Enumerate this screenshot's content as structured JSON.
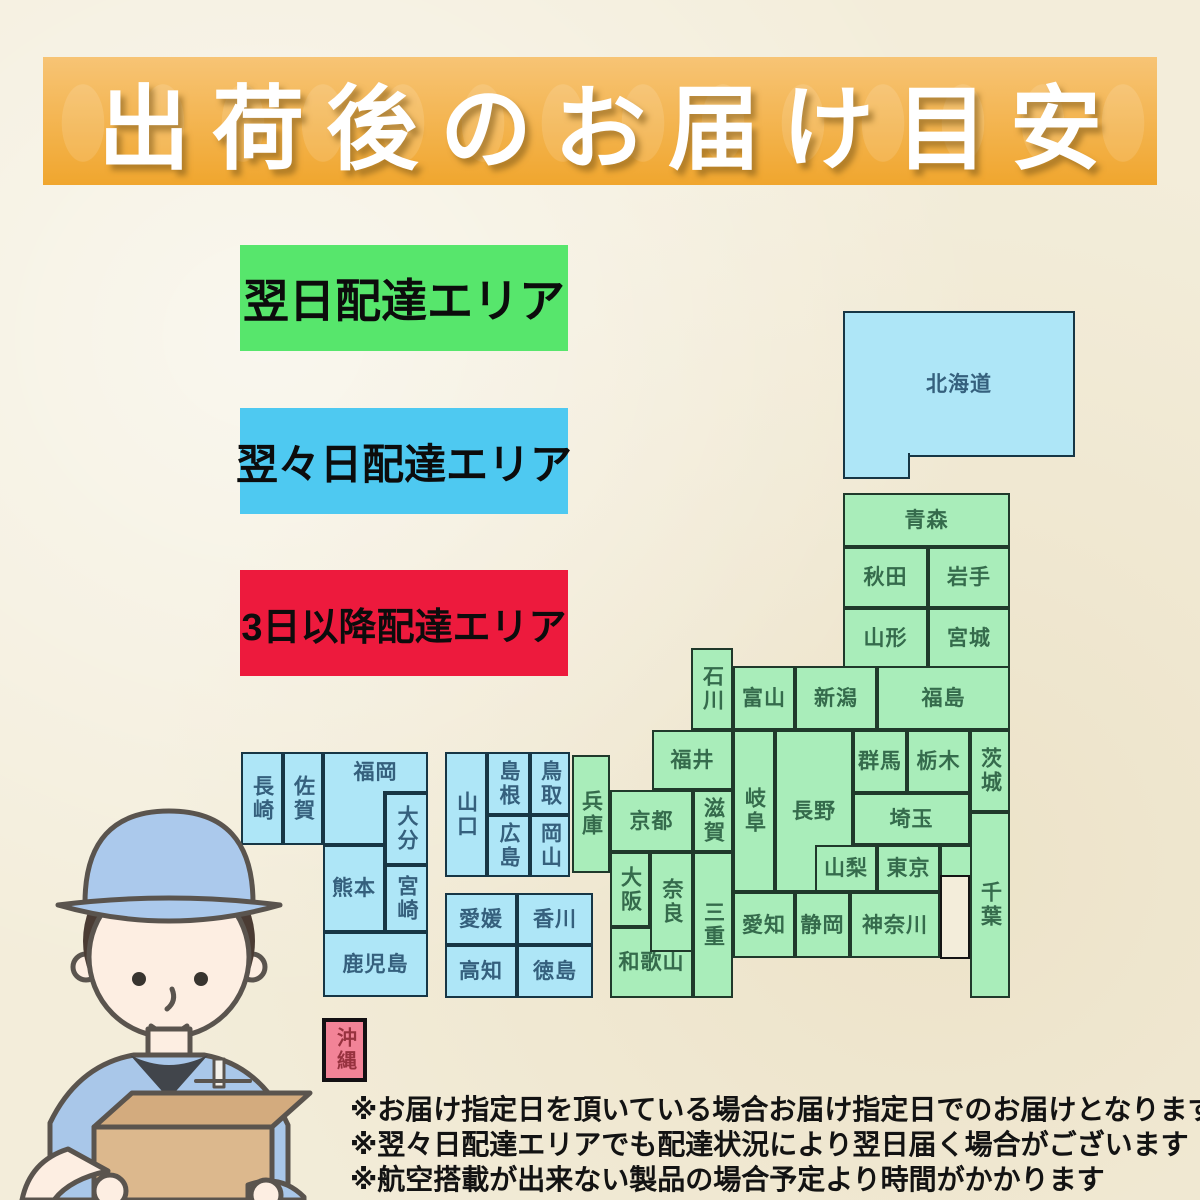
{
  "title": "出荷後のお届け目安",
  "legend": {
    "next_day": "翌日配達エリア",
    "two_day": "翌々日配達エリア",
    "three_day_plus": "3日以降配達エリア"
  },
  "colors": {
    "paper": "#f3edda",
    "banner_top": "#f7c475",
    "banner_bottom": "#f0a62e",
    "title_text": "#ffffff",
    "legend_green": "#57e66c",
    "legend_blue": "#4ec9f1",
    "legend_red": "#ed1a3d",
    "map_green": "#a9edba",
    "map_blue": "#aee6f7",
    "okinawa_pink": "#f28397"
  },
  "prefectures": {
    "hokkaido": "北海道",
    "aomori": "青森",
    "akita": "秋田",
    "iwate": "岩手",
    "yamagata": "山形",
    "miyagi": "宮城",
    "fukushima": "福島",
    "niigata": "新潟",
    "toyama": "富山",
    "ishikawa": "石川",
    "fukui": "福井",
    "gifu": "岐阜",
    "nagano": "長野",
    "gunma": "群馬",
    "tochigi": "栃木",
    "ibaraki": "茨城",
    "saitama": "埼玉",
    "chiba": "千葉",
    "yamanashi": "山梨",
    "tokyo": "東京",
    "aichi": "愛知",
    "shizuoka": "静岡",
    "kanagawa": "神奈川",
    "hyogo": "兵庫",
    "kyoto": "京都",
    "shiga": "滋賀",
    "osaka": "大阪",
    "nara": "奈良",
    "mie": "三重",
    "wakayama": "和歌山",
    "yamaguchi": "山口",
    "shimane": "島根",
    "tottori": "鳥取",
    "hiroshima": "広島",
    "okayama": "岡山",
    "ehime": "愛媛",
    "kagawa": "香川",
    "kochi": "高知",
    "tokushima": "徳島",
    "nagasaki": "長崎",
    "saga": "佐賀",
    "fukuoka": "福岡",
    "oita": "大分",
    "kumamoto": "熊本",
    "miyazaki": "宮崎",
    "kagoshima": "鹿児島",
    "okinawa": "沖縄"
  },
  "zone_assignment": {
    "next_day": [
      "青森",
      "秋田",
      "岩手",
      "山形",
      "宮城",
      "福島",
      "新潟",
      "富山",
      "石川",
      "福井",
      "岐阜",
      "長野",
      "群馬",
      "栃木",
      "茨城",
      "埼玉",
      "千葉",
      "山梨",
      "東京",
      "愛知",
      "静岡",
      "神奈川",
      "兵庫",
      "京都",
      "滋賀",
      "大阪",
      "奈良",
      "三重",
      "和歌山"
    ],
    "two_day": [
      "北海道",
      "山口",
      "島根",
      "鳥取",
      "広島",
      "岡山",
      "愛媛",
      "香川",
      "高知",
      "徳島",
      "長崎",
      "佐賀",
      "福岡",
      "大分",
      "熊本",
      "宮崎",
      "鹿児島"
    ],
    "three_day_plus": [
      "沖縄"
    ]
  },
  "footnotes": [
    "※お届け指定日を頂いている場合お届け指定日でのお届けとなります",
    "※翌々日配達エリアでも配達状況により翌日届く場合がございます",
    "※航空搭載が出来ない製品の場合予定より時間がかかります"
  ]
}
